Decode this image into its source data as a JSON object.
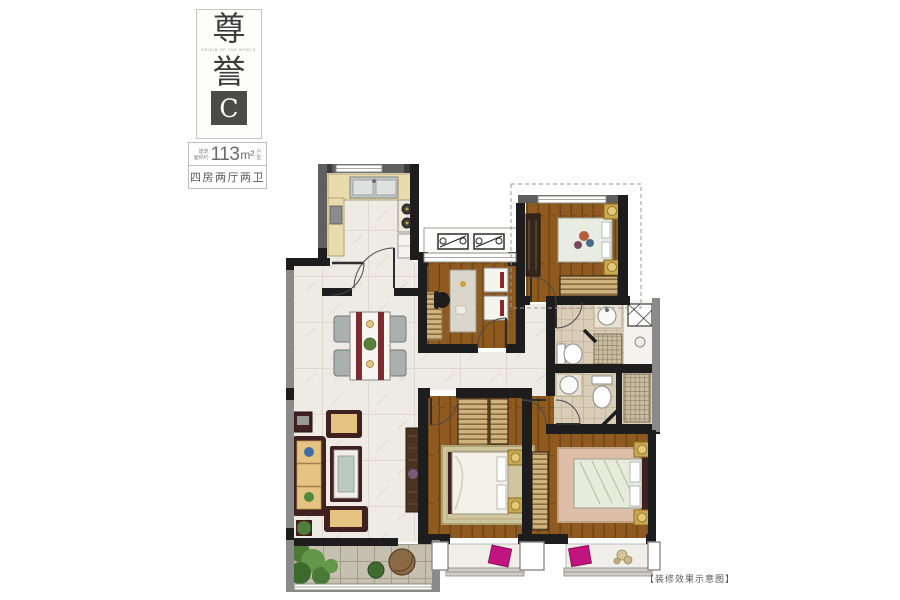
{
  "title_block": {
    "brand_char_1": "尊",
    "brand_char_2": "誉",
    "brand_subtext": "ORIGIN OF THE WORLD",
    "unit_label": "C",
    "area_label_line1": "建筑",
    "area_label_line2": "面积约",
    "area_value": "113",
    "area_unit": "m²",
    "area_suffix_line1": "户",
    "area_suffix_line2": "型",
    "layout_text": "四房两厅两卫"
  },
  "footnote": "【装修效果示意图】",
  "palette": {
    "wall_dark": "#1d1d1d",
    "wall_gray": "#6f6f6f",
    "wall_light_gray": "#8a8a8a",
    "wood_floor": "#8e5a1f",
    "marble_floor": "#edebe4",
    "bath_tile": "#dacdb8",
    "kitchen_counter": "#e8dbac",
    "furniture_dark": "#40211f",
    "cushion_tan": "#e5c380",
    "accent_gold": "#caa84e",
    "accent_magenta": "#c1147f",
    "plant_green": "#4c7a36",
    "balcony_tile": "#c6c0b0",
    "badge_bg": "#4b4b47"
  }
}
